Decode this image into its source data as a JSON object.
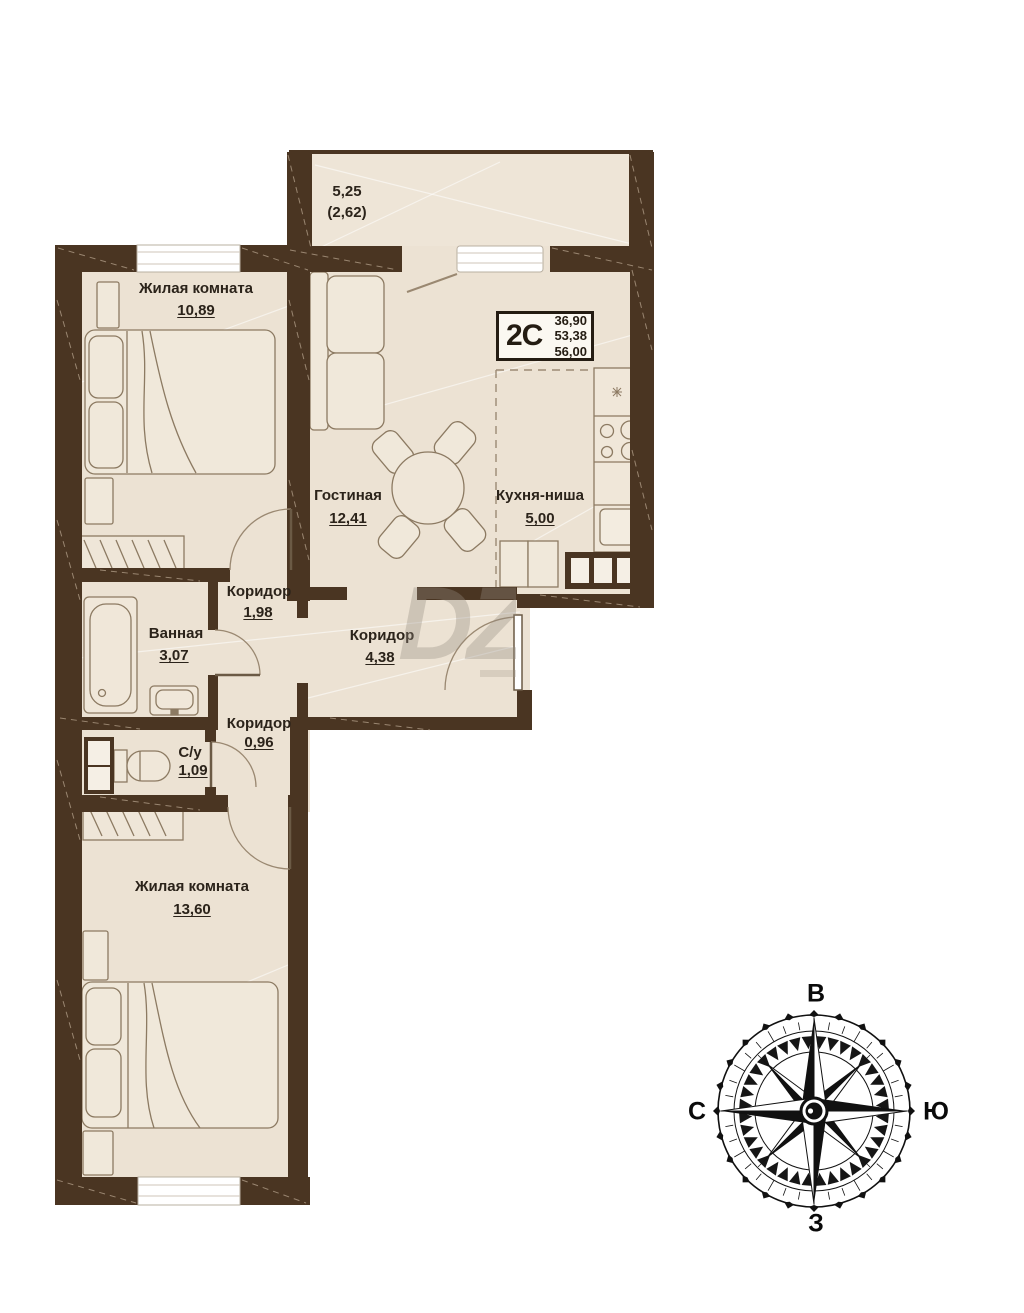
{
  "plan": {
    "balcony": {
      "area": "5,25",
      "area_reduced": "(2,62)"
    },
    "rooms": [
      {
        "name": "Жилая комната",
        "area": "10,89"
      },
      {
        "name": "Гостиная",
        "area": "12,41"
      },
      {
        "name": "Кухня-ниша",
        "area": "5,00"
      },
      {
        "name": "Коридор",
        "area": "1,98"
      },
      {
        "name": "Ванная",
        "area": "3,07"
      },
      {
        "name": "Коридор",
        "area": "4,38"
      },
      {
        "name": "Коридор",
        "area": "0,96"
      },
      {
        "name": "С/у",
        "area": "1,09"
      },
      {
        "name": "Жилая комната",
        "area": "13,60"
      }
    ],
    "info_box": {
      "type": "2C",
      "living_area": "36,90",
      "area": "53,38",
      "total_area": "56,00"
    },
    "compass": {
      "top": "В",
      "left": "С",
      "right": "Ю",
      "bottom": "З"
    },
    "watermark": "DZ",
    "colors": {
      "wall": "#4a3522",
      "floor": "#ece2d3",
      "text": "#2b231a"
    }
  }
}
